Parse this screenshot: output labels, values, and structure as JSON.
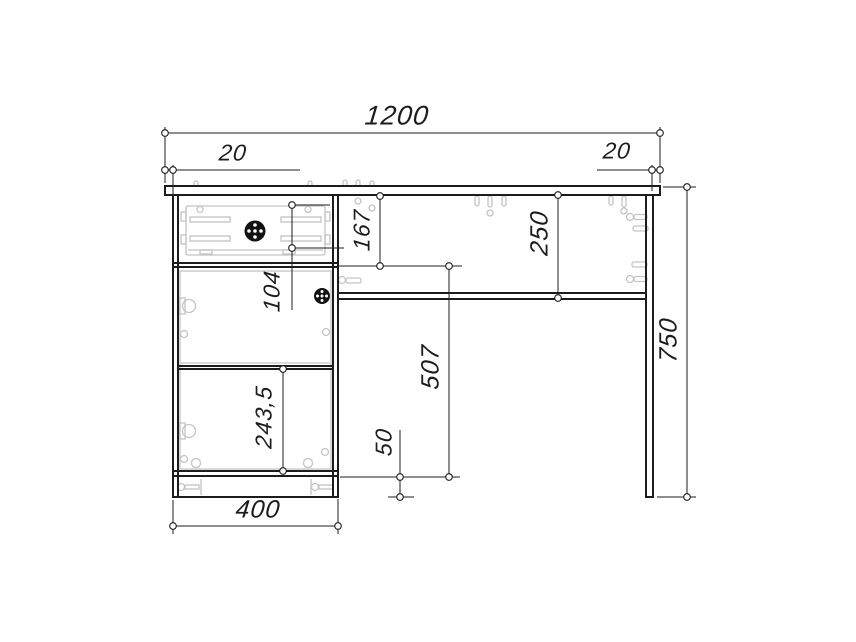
{
  "drawing": {
    "type": "furniture-technical-drawing-front-view",
    "colors": {
      "background": "#ffffff",
      "line": "#1c1c1c",
      "hardware": "#c4c4c4",
      "knob": "#111111"
    },
    "labels": {
      "total_width": "1200",
      "overhang_left": "20",
      "overhang_right": "20",
      "total_height": "750",
      "cabinet_width": "400",
      "drawer_section_height": "167",
      "worktop_to_shelf": "250",
      "drawer_box_height": "104",
      "door_lower_section": "243,5",
      "door_opening_height": "507",
      "plinth_height": "50"
    }
  }
}
